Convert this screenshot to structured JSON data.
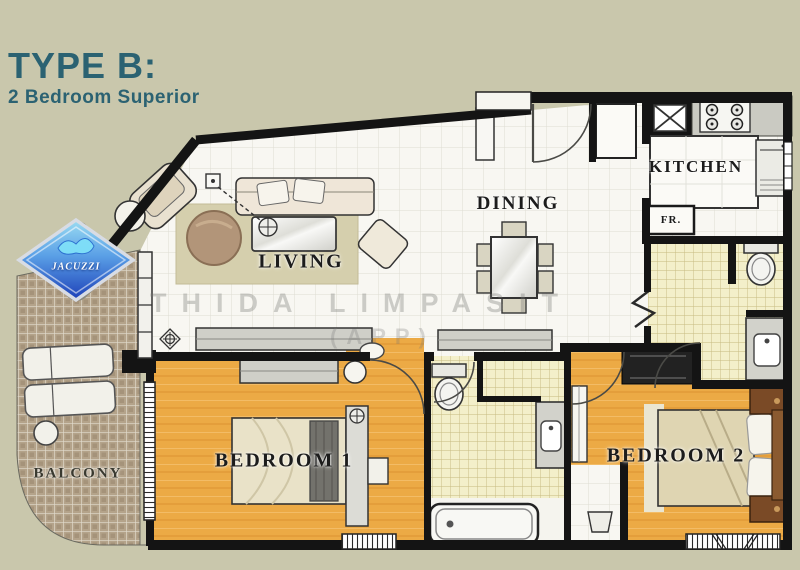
{
  "header": {
    "title": "TYPE B:",
    "subtitle": "2 Bedroom Superior"
  },
  "rooms": {
    "living": {
      "label": "LIVING"
    },
    "dining": {
      "label": "DINING"
    },
    "kitchen": {
      "label": "KITCHEN"
    },
    "balcony": {
      "label": "BALCONY"
    },
    "bedroom1": {
      "label": "BEDROOM 1"
    },
    "bedroom2": {
      "label": "BEDROOM 2"
    }
  },
  "fixtures": {
    "jacuzzi_label": "JACUZZI",
    "fridge_label": "FR."
  },
  "watermark": {
    "line1": "THIDA LIMPASIT",
    "line2": "(APP)"
  },
  "colors": {
    "background_beige": "#c9c7ac",
    "title_teal": "#2b6272",
    "wall_black": "#141414",
    "wood_floor_orange": "#ecaa45",
    "bath_tile_yellow": "#f3efca",
    "balcony_tile_tan": "#b4a38a",
    "jacuzzi_blue": "#2a55c8",
    "furniture_gray": "#cfcfc8"
  }
}
